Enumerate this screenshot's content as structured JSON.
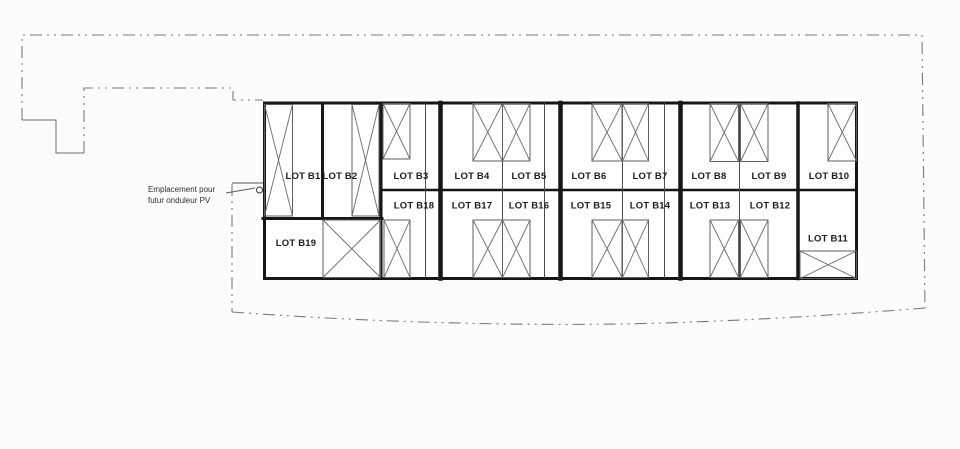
{
  "plan": {
    "lots": {
      "b1": "LOT B1",
      "b2": "LOT B2",
      "b3": "LOT B3",
      "b4": "LOT B4",
      "b5": "LOT B5",
      "b6": "LOT B6",
      "b7": "LOT B7",
      "b8": "LOT B8",
      "b9": "LOT B9",
      "b10": "LOT B10",
      "b11": "LOT B11",
      "b12": "LOT B12",
      "b13": "LOT B13",
      "b14": "LOT B14",
      "b15": "LOT B15",
      "b16": "LOT B16",
      "b17": "LOT B17",
      "b18": "LOT B18",
      "b19": "LOT B19"
    },
    "annotation": {
      "line1": "Emplacement pour",
      "line2": "futur onduleur PV"
    },
    "colors": {
      "wall_ink": "#161616",
      "thin_line": "#4b4b4b",
      "door_line": "#5f5f5f",
      "boundary_line": "#7a7a7a",
      "paper": "#fcfcfc",
      "label_text": "#1d1d1d"
    }
  }
}
